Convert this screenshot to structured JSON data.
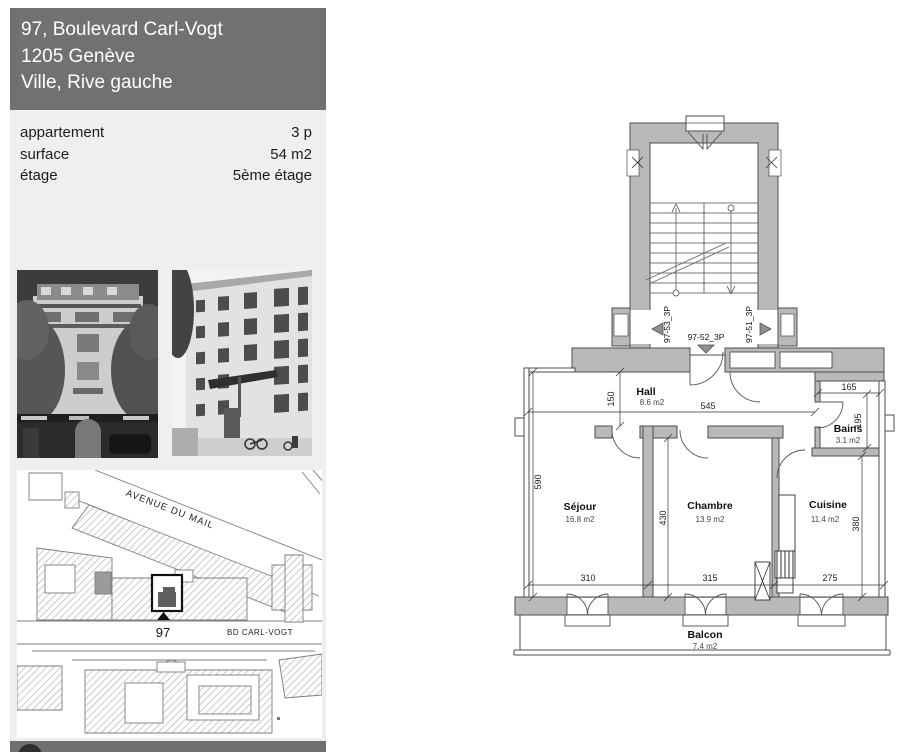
{
  "listing": {
    "address_line1": "97, Boulevard Carl-Vogt",
    "address_line2": "1205 Genève",
    "address_line3": "Ville, Rive gauche",
    "details": [
      {
        "label": "appartement",
        "value": "3 p"
      },
      {
        "label": "surface",
        "value": "54 m2"
      },
      {
        "label": "étage",
        "value": "5ème étage"
      }
    ]
  },
  "map": {
    "street1": "AVENUE DU MAIL",
    "street2": "BD CARL-VOGT",
    "building_number": "97"
  },
  "plan": {
    "units": {
      "left": "97-53_3P",
      "center": "97-52_3P",
      "right": "97-51_3P"
    },
    "rooms": {
      "hall": {
        "name": "Hall",
        "area": "8.6 m2"
      },
      "bains": {
        "name": "Bains",
        "area": "3.1 m2"
      },
      "sejour": {
        "name": "Séjour",
        "area": "16.8 m2"
      },
      "chambre": {
        "name": "Chambre",
        "area": "13.9 m2"
      },
      "cuisine": {
        "name": "Cuisine",
        "area": "11.4 m2"
      },
      "balcon": {
        "name": "Balcon",
        "area": "7.4 m2"
      }
    },
    "dims": {
      "hall_depth": "150",
      "hall_width": "545",
      "bains_width": "165",
      "bains_depth": "195",
      "sejour_height": "590",
      "chambre_height": "430",
      "cuisine_height": "380",
      "sejour_width": "310",
      "chambre_width": "315",
      "cuisine_width": "275"
    }
  },
  "colors": {
    "header_bg": "#717171",
    "panel_bg": "#f0efee",
    "wall_fill": "#b9b9b9",
    "marker_dark": "#5f5f5f"
  }
}
